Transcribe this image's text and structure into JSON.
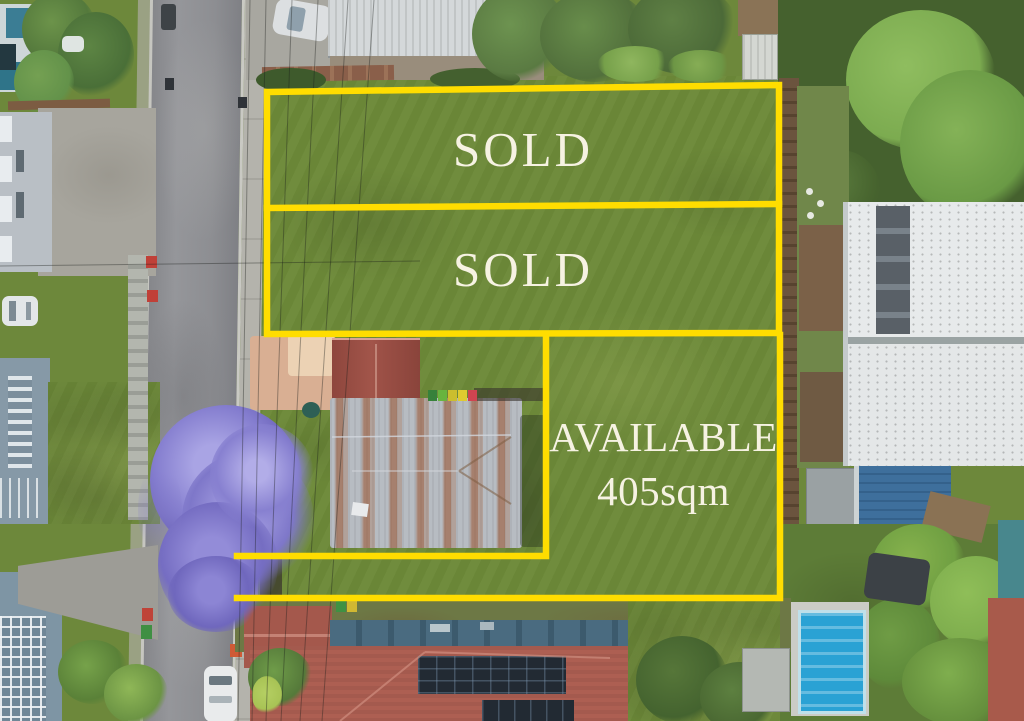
{
  "colors": {
    "boundary_yellow": "#ffdd00",
    "label_text": "#f6f2e2"
  },
  "lots": [
    {
      "name": "rear-lot",
      "label": "SOLD"
    },
    {
      "name": "middle-lot",
      "label": "SOLD"
    },
    {
      "name": "front-lot",
      "label": "AVAILABLE",
      "area": "405sqm"
    }
  ]
}
